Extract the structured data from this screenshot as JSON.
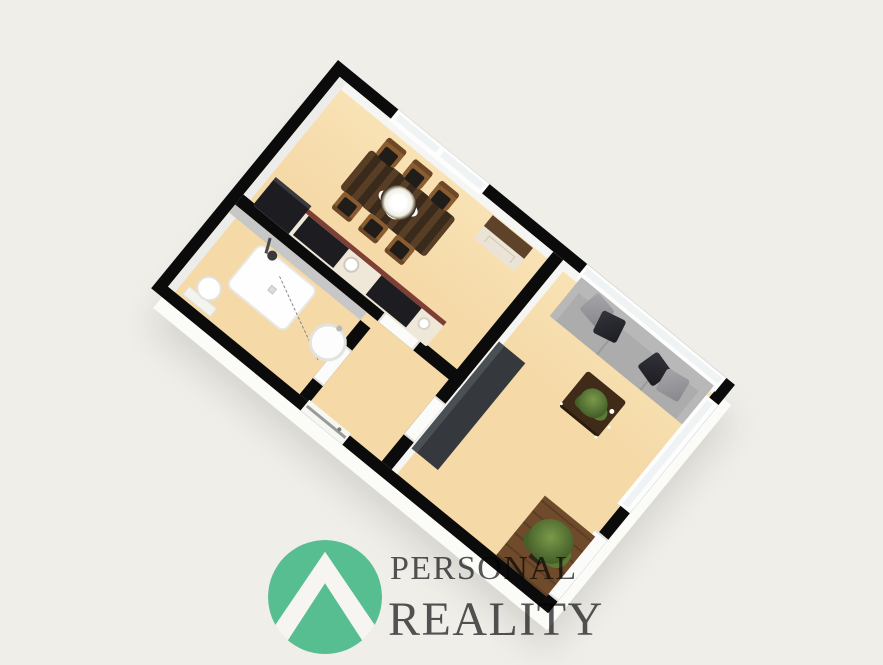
{
  "brand": {
    "line1": "PERSONAL",
    "line2": "REALITY"
  },
  "logo": {
    "icon": "mountain-chevron-in-circle"
  },
  "colors": {
    "bg": "#F0EEE9",
    "floor": "#F5D9A7",
    "floorLight": "#F9E3B6",
    "wall": "#0B0B0B",
    "wallFace": "#F5F5F3",
    "wallFaceDim": "#ECECEA",
    "wallFaceShade": "#C7C7C7",
    "doorWhite": "#FBFBF9",
    "glass": "#EFF3F4",
    "counterEdge": "#7E4034",
    "appliance": "#1D1D21",
    "counterBody": "#EFE8D8",
    "tableWood": "#3A2A1B",
    "tableWoodLight": "#5A4026",
    "chairWood": "#8A5C31",
    "chairWoodDark": "#6E4826",
    "seatDark": "#201D19",
    "sideboardTop": "#5E422A",
    "cream": "#EBE4D6",
    "sofa": "#ACACAC",
    "sofaLight": "#B8B8B8",
    "sofaShade": "#9A9A9A",
    "pillowDark": "#26262B",
    "pillowGray": "#96969A",
    "coffee": "#3F2B17",
    "lowboard": "#35393D",
    "lowboardHL": "#4B5055",
    "rug": "#6F4B2C",
    "leaf": "#5B7A36",
    "leafDark": "#46602A",
    "leafLight": "#7A9A4A",
    "white": "#FDFDFD",
    "logoGreen": "#57BE92",
    "textGray": "#57575A"
  },
  "floorplan": {
    "type": "3d-floorplan",
    "view": "isometric-top",
    "rotation_deg": 39.3,
    "rooms": [
      {
        "name": "kitchen-dining",
        "furniture": [
          "dining-table",
          "dining-chair x6",
          "flower-centerpiece",
          "sideboard",
          "kitchen-counter",
          "fridge",
          "cooktop",
          "kitchen-sink"
        ]
      },
      {
        "name": "bathroom",
        "furniture": [
          "shower-tray",
          "shower-head",
          "toilet",
          "round-washbasin"
        ]
      },
      {
        "name": "hallway",
        "furniture": []
      },
      {
        "name": "living-room",
        "furniture": [
          "gray-sofa",
          "cushions x4",
          "coffee-table",
          "table-plant",
          "tv-lowboard",
          "floor-plant",
          "wood-rug"
        ]
      }
    ],
    "openings": [
      "dining-window",
      "living-room-window",
      "side-window",
      "balcony-door",
      "entrance-door",
      "bathroom-door",
      "kitchen-door",
      "living-room-door"
    ]
  }
}
